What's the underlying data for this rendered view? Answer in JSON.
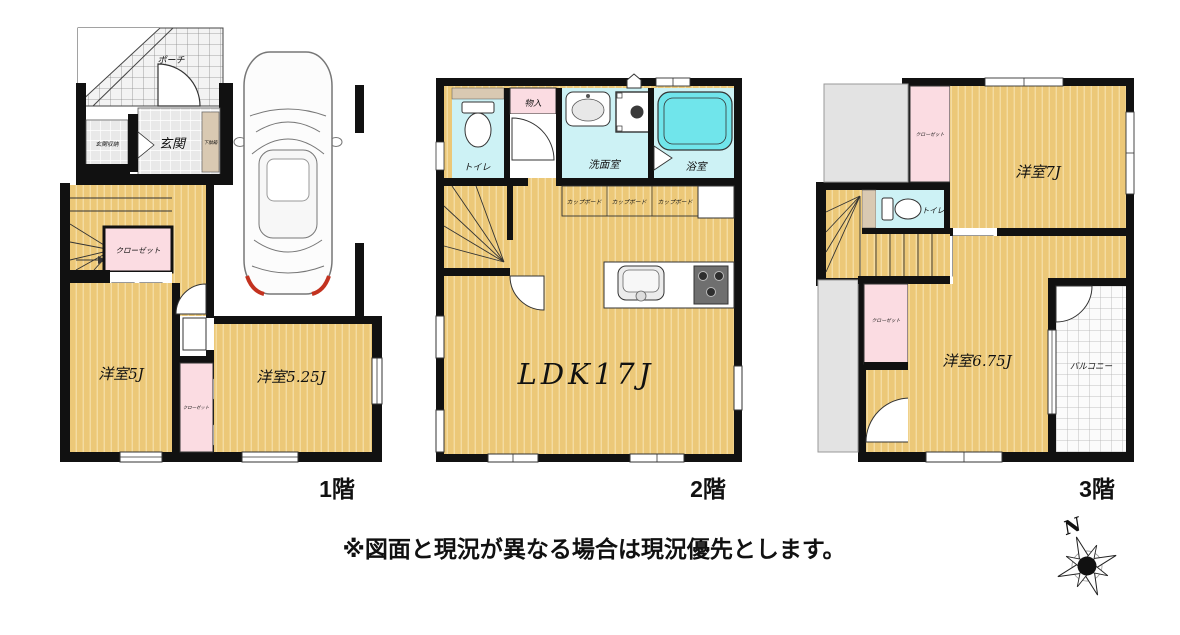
{
  "note": "※図面と現況が異なる場合は現況優先とします。",
  "compass": {
    "north": "N"
  },
  "floors": [
    {
      "label": "1階",
      "rooms": {
        "porch": "ポーチ",
        "entrance": "玄関",
        "entrance_storage": "玄関収納",
        "shoe_cabinet": "下駄箱",
        "closet_hall": "クローゼット",
        "western_room_5": "洋室5J",
        "closet_strip": "クローゼット",
        "western_room_5_25": "洋室5.25J"
      }
    },
    {
      "label": "2階",
      "rooms": {
        "toilet": "トイレ",
        "storage": "物入",
        "washroom": "洗面室",
        "bathroom": "浴室",
        "cupboard_1": "カップボード",
        "cupboard_2": "カップボード",
        "cupboard_3": "カップボード",
        "ldk": "LDK17J"
      }
    },
    {
      "label": "3階",
      "rooms": {
        "closet_north": "クローゼット",
        "western_room_7": "洋室7J",
        "toilet": "トイレ",
        "closet_west": "クローゼット",
        "western_room_6_75": "洋室6.75J",
        "balcony": "バルコニー"
      }
    }
  ],
  "colors": {
    "floor_yellow": "#ecc878",
    "floor_stripe": "#f5dfa6",
    "closet_pink": "#fbdce2",
    "wet_cyan": "#cdf2f5",
    "bathtub_cyan": "#70e5eb",
    "counter_beige": "#d9c9b2",
    "roof_gray": "#e3e3e3",
    "wall_black": "#111111",
    "accent_red": "#c3321f"
  }
}
